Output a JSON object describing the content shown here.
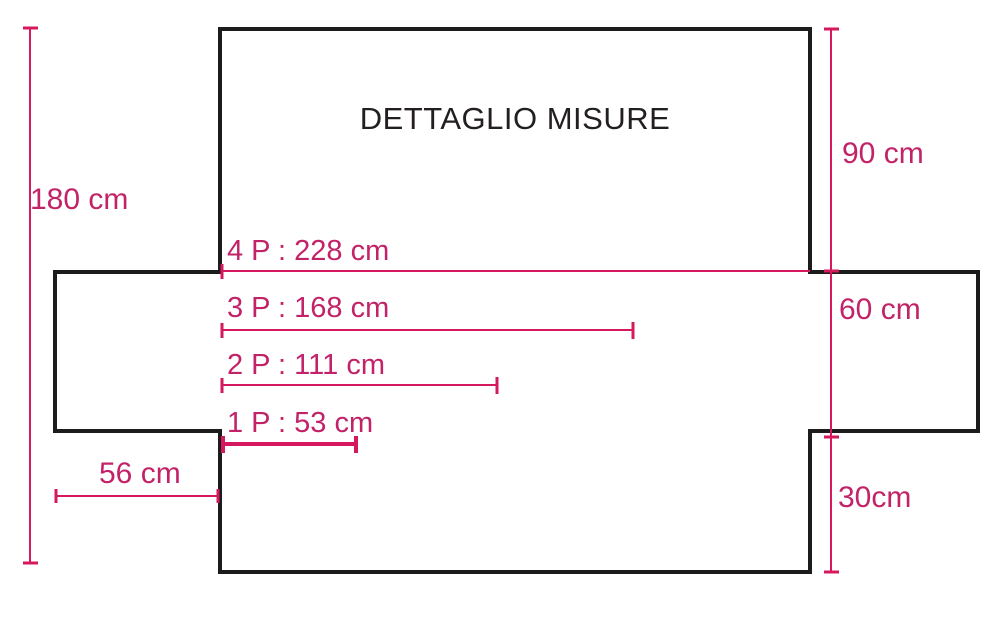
{
  "title": "DETTAGLIO MISURE",
  "colors": {
    "outline": "#1c1c1c",
    "dim-line": "#d6195e",
    "accent-text": "#c22368"
  },
  "dimensions": {
    "total_height": "180 cm",
    "back_height": "90 cm",
    "side_depth": "60 cm",
    "front_drop": "30cm",
    "armrest_width": "56 cm",
    "seats_4": "4 P : 228 cm",
    "seats_3": "3 P : 168 cm",
    "seats_2": "2 P : 111 cm",
    "seats_1": "1 P : 53 cm"
  }
}
